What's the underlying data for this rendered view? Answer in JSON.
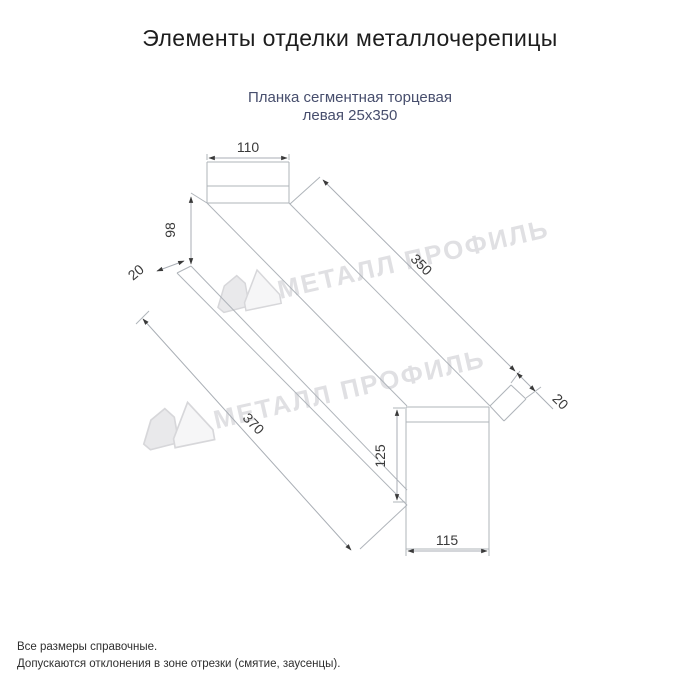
{
  "header": {
    "title": "Элементы отделки металлочерепицы"
  },
  "product": {
    "line1": "Планка сегментная торцевая",
    "line2": "левая 25x350"
  },
  "dims": {
    "cap_width": "110",
    "side_height": "98",
    "hem_left": "20",
    "length_top": "350",
    "hem_right": "20",
    "length_bottom": "370",
    "end_height": "125",
    "end_width": "115"
  },
  "watermark": {
    "brand": "МЕТАЛЛ ПРОФИЛЬ"
  },
  "notes": {
    "line1": "Все размеры справочные.",
    "line2": "Допускаются отклонения в зоне отрезки (смятие, заусенцы)."
  },
  "colors": {
    "title_text": "#1d1d1d",
    "subtitle_text": "#474e6d",
    "drawing_line": "#afb4ba",
    "dimension_text": "#3a3a3a",
    "watermark": "#e0e0e3"
  }
}
